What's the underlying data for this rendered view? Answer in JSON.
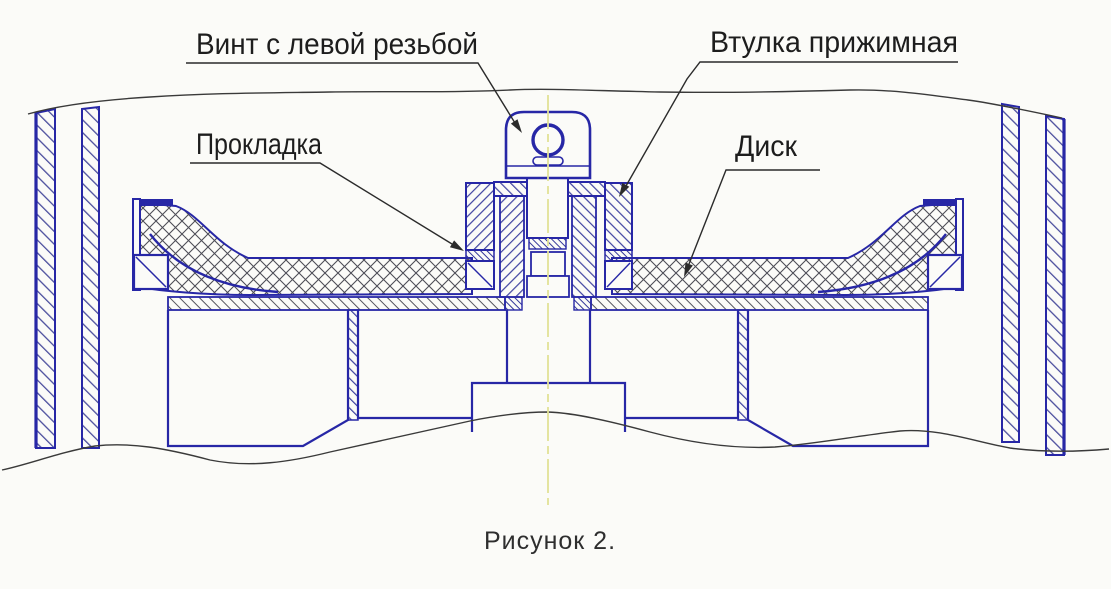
{
  "figure": {
    "caption": "Рисунок 2.",
    "labels": {
      "screw": {
        "text": "Винт с левой резьбой"
      },
      "sleeve": {
        "text": "Втулка прижимная"
      },
      "gasket": {
        "text": "Прокладка"
      },
      "disk": {
        "text": "Диск"
      }
    },
    "colors": {
      "line_blue": "#2727a6",
      "hatch_blue": "#4b4e9d",
      "hatch_gray": "#4d4d57",
      "break_line": "#3a3a3a",
      "centerline_yellow": "#e2e296",
      "label_text": "#1d1d1d",
      "background": "#fbfbf8"
    }
  }
}
